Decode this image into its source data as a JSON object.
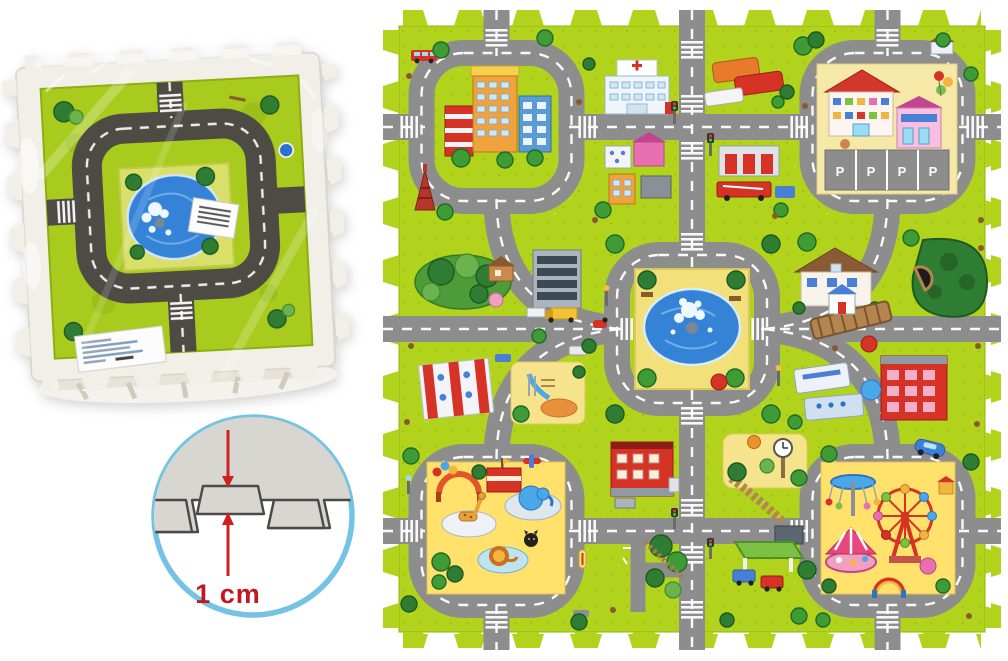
{
  "thickness_diagram": {
    "label": "1 cm",
    "circle_color": "#74c3e4",
    "foam_color": "#d7d6d1",
    "arrow_color": "#d0201f"
  },
  "parking_lot": {
    "space_label": "P",
    "space_count": 4
  },
  "colors": {
    "mat_green": "#b2d31c",
    "road_gray": "#8d8d8d",
    "package_road_dark": "#4d4b44",
    "pond_blue": "#3583d6",
    "sand_yellow": "#f2e17b",
    "foam_white": "#f2efe8",
    "accent_red": "#d63226"
  },
  "package": {
    "design": "ring-road-with-center-pond",
    "sticker": "product-label",
    "barcode_sticker": "barcode-label"
  },
  "tiles": [
    {
      "id": "tile-city-buildings",
      "landmark": "high-rise-buildings"
    },
    {
      "id": "tile-hospital-crossroads",
      "landmark": "hospital"
    },
    {
      "id": "tile-school-parking",
      "landmark": "school-with-parking-lot"
    },
    {
      "id": "tile-forest-office-playground",
      "landmark": "forest-office-playground"
    },
    {
      "id": "tile-central-fountain",
      "landmark": "fountain-pond"
    },
    {
      "id": "tile-villa-bridge-tunnel",
      "landmark": "villa-bridge-tunnel"
    },
    {
      "id": "tile-zoo",
      "landmark": "zoo-animals"
    },
    {
      "id": "tile-apartment-gas-station",
      "landmark": "apartment-gas-station"
    },
    {
      "id": "tile-funfair",
      "landmark": "ferris-wheel-carousel"
    }
  ]
}
